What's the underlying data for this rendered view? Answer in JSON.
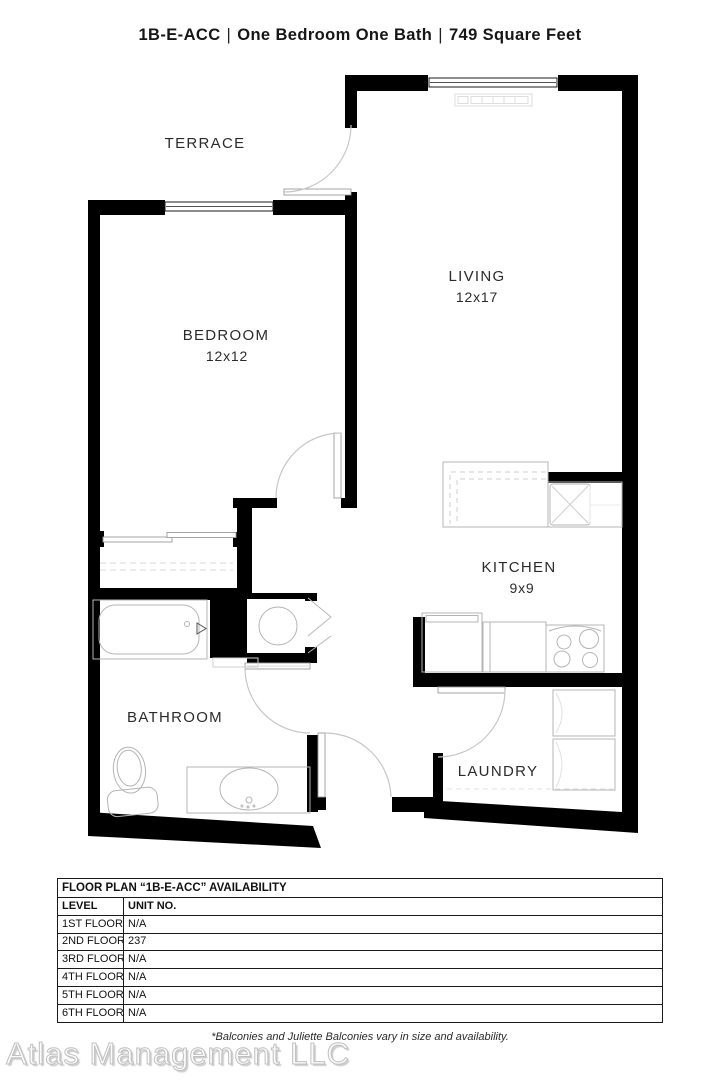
{
  "header": {
    "plan_code": "1B-E-ACC",
    "separator": "|",
    "descriptor": "One Bedroom One Bath",
    "area": "749 Square Feet"
  },
  "floor_plan": {
    "rooms": [
      {
        "name": "TERRACE",
        "dims": ""
      },
      {
        "name": "BEDROOM",
        "dims": "12x12"
      },
      {
        "name": "LIVING",
        "dims": "12x17"
      },
      {
        "name": "KITCHEN",
        "dims": "9x9"
      },
      {
        "name": "BATHROOM",
        "dims": ""
      },
      {
        "name": "LAUNDRY",
        "dims": ""
      }
    ]
  },
  "availability": {
    "title": "FLOOR PLAN “1B-E-ACC” AVAILABILITY",
    "columns": [
      "LEVEL",
      "UNIT NO."
    ],
    "rows": [
      {
        "level": "1ST FLOOR",
        "unit": "N/A"
      },
      {
        "level": "2ND FLOOR",
        "unit": "237"
      },
      {
        "level": "3RD FLOOR",
        "unit": "N/A"
      },
      {
        "level": "4TH FLOOR",
        "unit": "N/A"
      },
      {
        "level": "5TH FLOOR",
        "unit": "N/A"
      },
      {
        "level": "6TH FLOOR",
        "unit": "N/A"
      }
    ]
  },
  "footer": {
    "watermark": "Atlas Management LLC",
    "note": "*Balconies and Juliette Balconies vary in size and availability."
  },
  "colors": {
    "wall": "#000000",
    "fixture_line": "#b4b4b4",
    "door_arc": "#c6c6c6",
    "label_text": "#2b2b2b"
  }
}
